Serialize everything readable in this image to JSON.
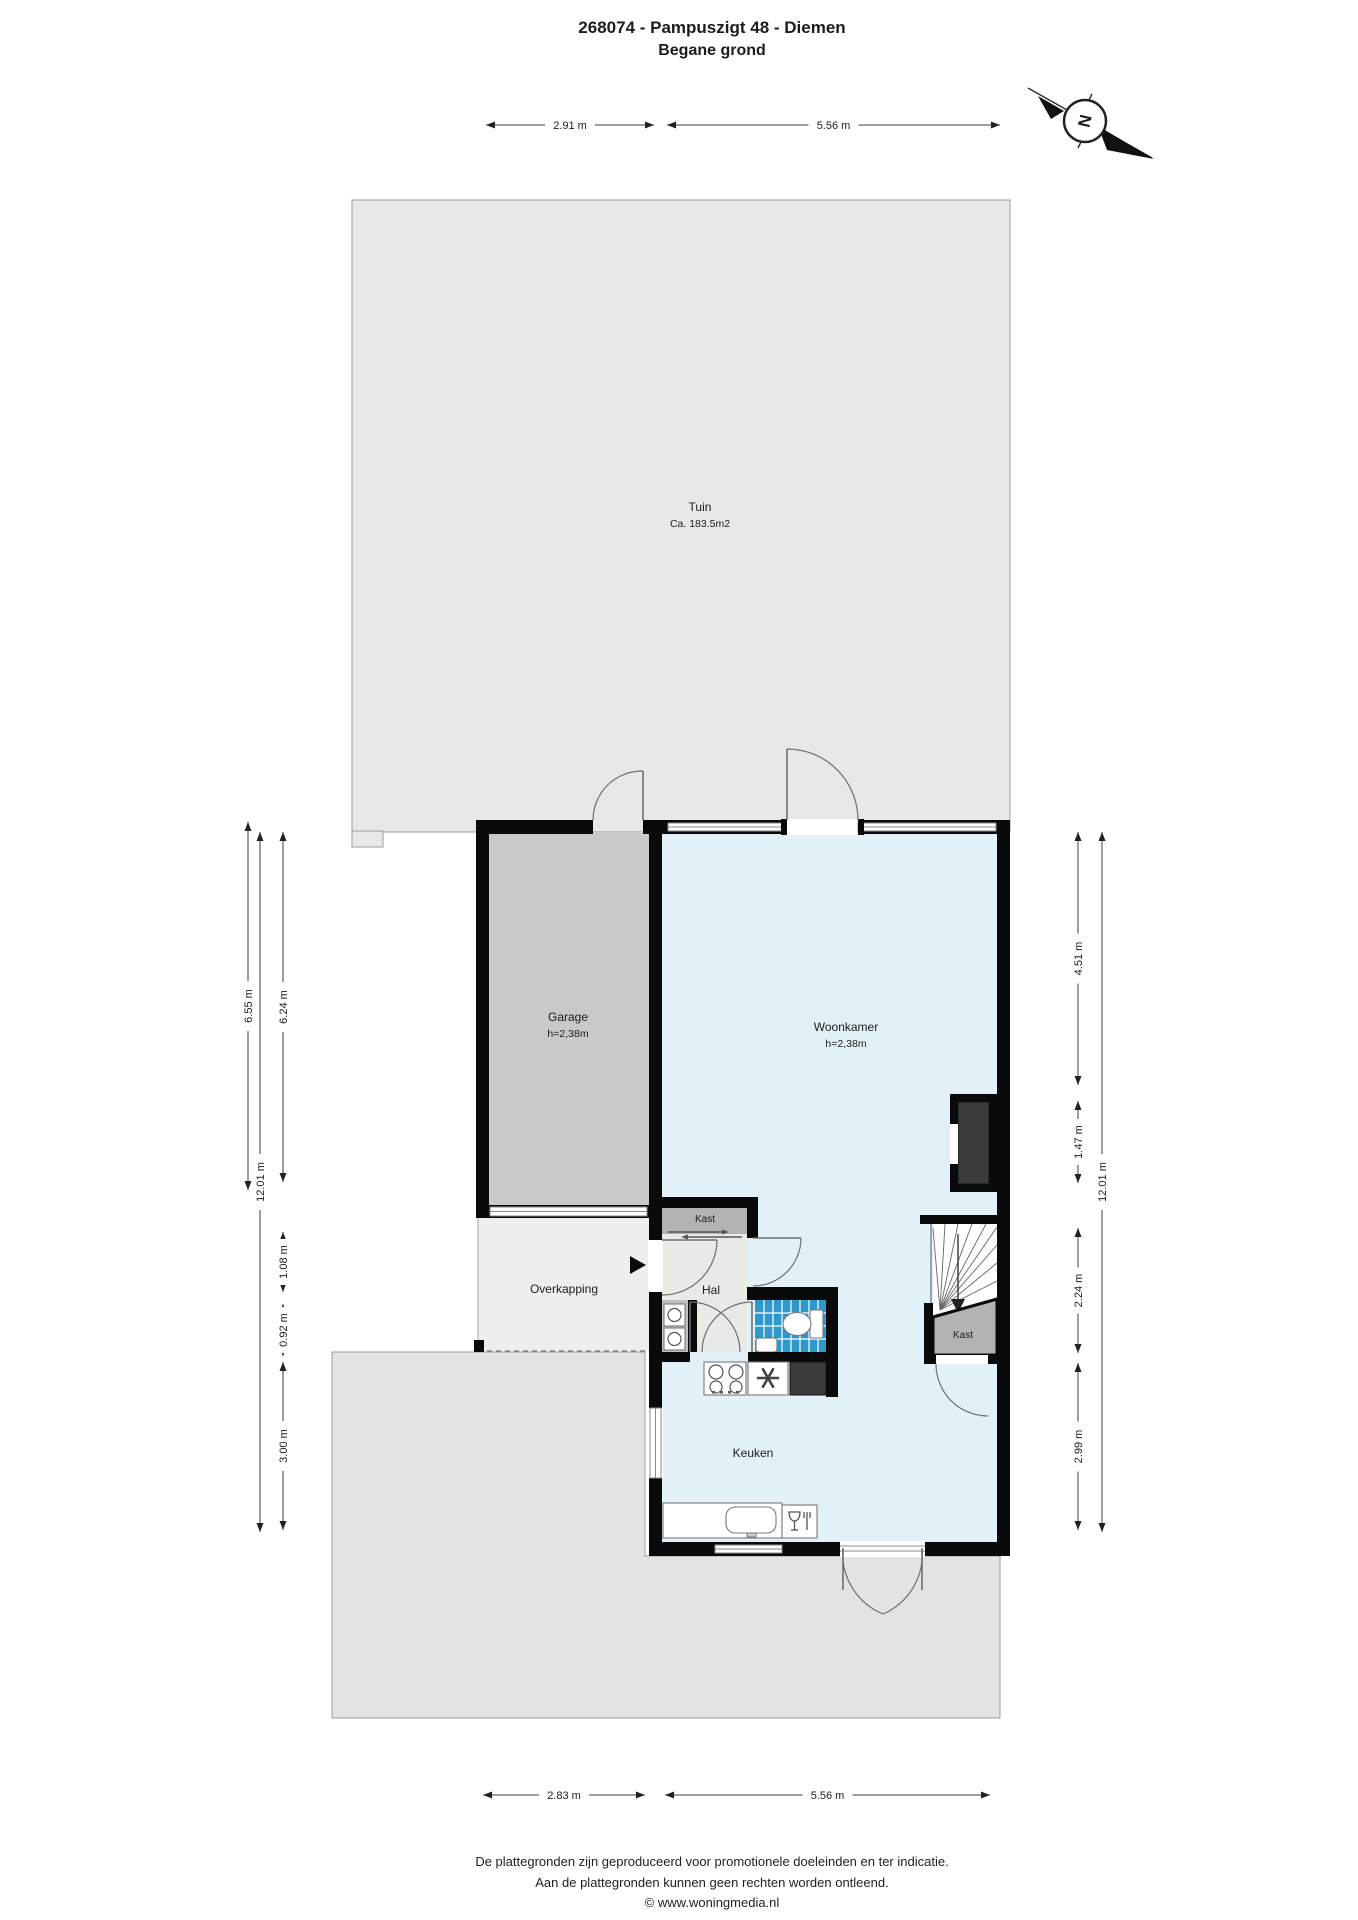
{
  "title": "268074 - Pampuszigt 48 - Diemen",
  "subtitle": "Begane grond",
  "compass": {
    "north_label": "N"
  },
  "rooms": {
    "tuin": {
      "name": "Tuin",
      "area": "Ca. 183.5m2"
    },
    "garage": {
      "name": "Garage",
      "ceiling": "h=2,38m"
    },
    "woonkamer": {
      "name": "Woonkamer",
      "ceiling": "h=2,38m"
    },
    "kast_hal": {
      "name": "Kast"
    },
    "hal": {
      "name": "Hal"
    },
    "overkapping": {
      "name": "Overkapping"
    },
    "keuken": {
      "name": "Keuken"
    },
    "kast_trap": {
      "name": "Kast"
    }
  },
  "dimensions": {
    "top": [
      "2.91 m",
      "5.56 m"
    ],
    "bottom": [
      "2.83 m",
      "5.56 m"
    ],
    "left": [
      "6.55 m",
      "12.01 m",
      "6.24 m",
      "1.08 m",
      "0.92 m",
      "3.00 m"
    ],
    "right": [
      "4.51 m",
      "1.47 m",
      "12.01 m",
      "2.24 m",
      "2.99 m"
    ]
  },
  "footer": [
    "De plattegronden zijn geproduceerd voor promotionele doeleinden en ter indicatie.",
    "Aan de plattegronden kunnen geen rechten worden ontleend.",
    "© www.woningmedia.nl"
  ],
  "colors": {
    "wall": "#0a0a0a",
    "garden": "#e8e8e8",
    "terrain": "#e3e3e3",
    "overkapping": "#eeeeee",
    "garage_floor": "#c9c9c9",
    "living_floor": "#e2f1f8",
    "hall_floor": "#e9e9e6",
    "closet": "#b3b3b3",
    "wc_tile": "#2e97cb",
    "appliance_dark": "#3b3b3b"
  }
}
